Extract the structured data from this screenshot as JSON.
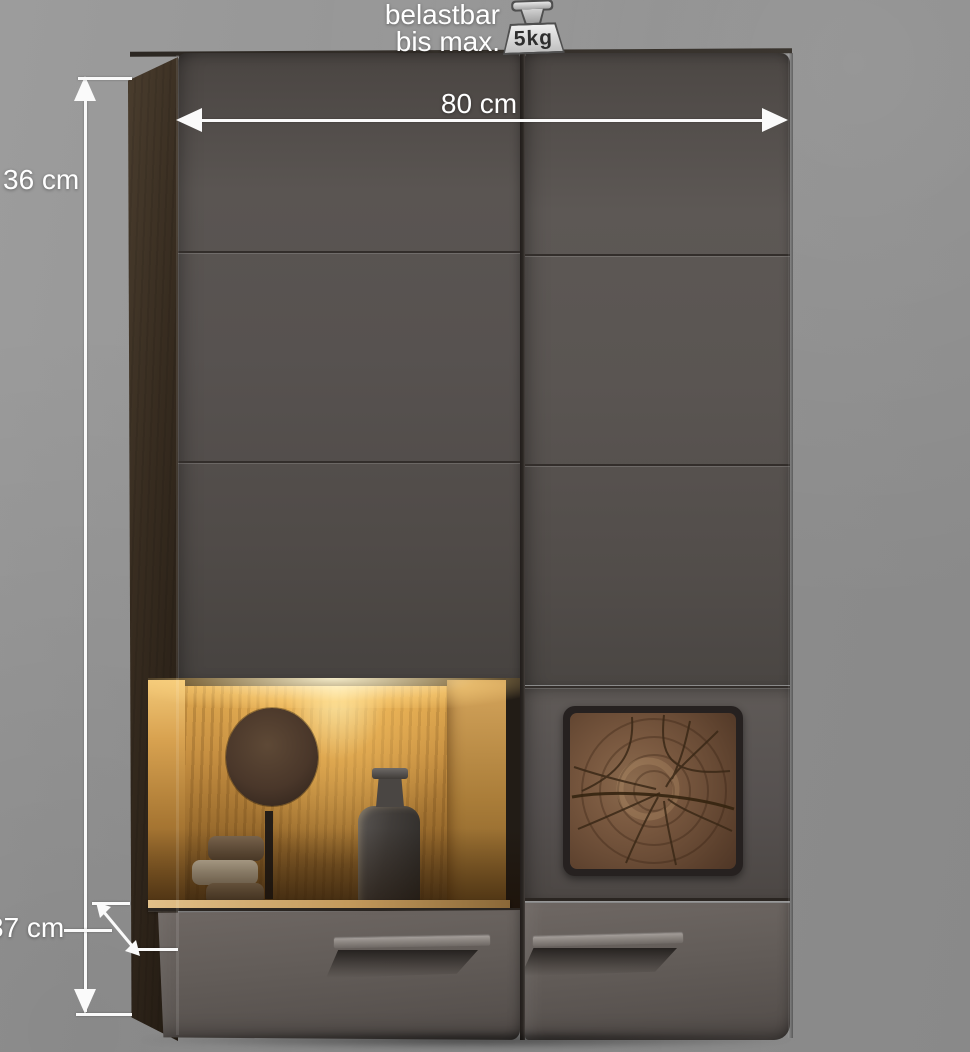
{
  "header": {
    "load_line1": "belastbar",
    "load_line2": "bis max.",
    "weight_value": "5kg"
  },
  "dimensions": {
    "width_label": "80 cm",
    "height_label": "36 cm",
    "depth_label": "37 cm"
  },
  "icons": {
    "weight": "weight-icon"
  },
  "colors": {
    "background": "#8f8f8f",
    "door_front": "#544f4c",
    "drawer_front": "#615b57",
    "side_panel_wood": "#2e2720",
    "interior_oak": "#b5813c",
    "interior_glow": "#ffd27e",
    "tree_ring_panel": "#77553c",
    "annotation": "#ffffff"
  }
}
